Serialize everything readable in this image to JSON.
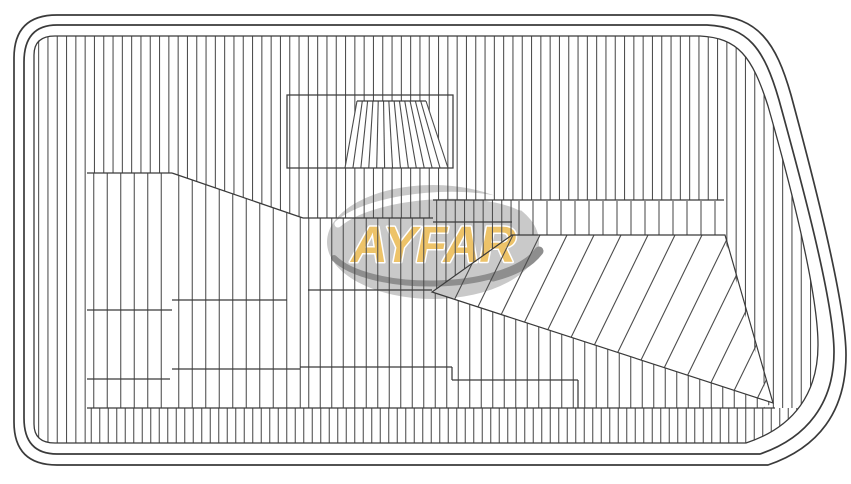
{
  "meta": {
    "title": "AYFAR headlamp lens technical drawing"
  },
  "logo": {
    "text": "AYFAR",
    "text_color": "#EDC369",
    "text_outline": "#FFFFFF",
    "ellipse_color": "#C9C9C9",
    "highlight_color": "#FFFFFF",
    "swoosh_color": "#8E8E8E"
  },
  "drawing": {
    "canvas": {
      "width": 851,
      "height": 484,
      "background": "#FFFFFF"
    },
    "line_color": "#4C4C4C",
    "border_color": "#3A3A3A",
    "borders": {
      "outer": "M 57,15 L 712,15 C 758,17 776,42 791,95 C 808,158 846,300 846,355 C 846,412 818,448 768,465 L 57,465 Q 14,465 14,422 L 14,58 Q 14,15 57,15 Z",
      "inner": "M 57,25 L 707,25 C 748,27 764,48 779,100 C 796,162 834,298 834,352 C 834,403 807,438 760,454 L 57,454 Q 24,454 24,418 L 24,62 Q 24,25 57,25 Z",
      "hatch_boundary": "M 55,36 L 700,36 C 738,38 752,56 768,106 C 788,176 818,290 818,345 C 818,392 795,427 746,443 L 55,443 Q 34,443 34,424 L 34,55 Q 34,36 55,36 Z"
    },
    "regions": [
      {
        "name": "main-field",
        "type": "v",
        "pitch": 9.3,
        "points": [
          [
            34,
            36
          ],
          [
            845,
            36
          ],
          [
            845,
            408
          ],
          [
            763,
            408
          ],
          [
            769,
            403
          ],
          [
            724,
            236
          ],
          [
            724,
            200
          ],
          [
            433,
            200
          ],
          [
            433,
            218
          ],
          [
            303,
            218
          ],
          [
            172,
            173
          ],
          [
            87,
            173
          ],
          [
            87,
            443
          ],
          [
            34,
            443
          ]
        ]
      },
      {
        "name": "sub-top",
        "type": "v",
        "pitch": 9.3,
        "points": [
          [
            433,
            200
          ],
          [
            512,
            200
          ],
          [
            512,
            235
          ],
          [
            432,
            292
          ]
        ]
      },
      {
        "name": "mid-tick-band",
        "type": "v",
        "pitch": 14,
        "points": [
          [
            512,
            201
          ],
          [
            724,
            201
          ],
          [
            724,
            235
          ],
          [
            512,
            235
          ]
        ]
      },
      {
        "name": "mid-left-a",
        "type": "v",
        "pitch": 13.5,
        "points": [
          [
            87,
            173
          ],
          [
            172,
            173
          ],
          [
            172,
            408
          ],
          [
            87,
            408
          ]
        ]
      },
      {
        "name": "mid-left-b",
        "type": "v",
        "pitch": 13.5,
        "points": [
          [
            172,
            173
          ],
          [
            303,
            218
          ],
          [
            303,
            408
          ],
          [
            172,
            408
          ]
        ]
      },
      {
        "name": "mid-low",
        "type": "v",
        "pitch": 11.5,
        "points": [
          [
            303,
            218
          ],
          [
            433,
            218
          ],
          [
            432,
            292
          ],
          [
            773,
            403
          ],
          [
            763,
            408
          ],
          [
            303,
            408
          ]
        ]
      },
      {
        "name": "corner-fan",
        "type": "d",
        "pitch": 27,
        "angle": 64,
        "points": [
          [
            512,
            235
          ],
          [
            725,
            235
          ],
          [
            773,
            403
          ],
          [
            432,
            292
          ]
        ]
      },
      {
        "name": "bottom-band",
        "type": "v",
        "pitch": 8.5,
        "points": [
          [
            87,
            408
          ],
          [
            805,
            408
          ],
          [
            805,
            443
          ],
          [
            87,
            443
          ]
        ]
      }
    ],
    "fan_outline": [
      [
        512,
        235
      ],
      [
        725,
        235
      ],
      [
        773,
        403
      ],
      [
        432,
        292
      ]
    ],
    "boundary_segments": [
      [
        87,
        173,
        172,
        173
      ],
      [
        172,
        173,
        303,
        218
      ],
      [
        303,
        218,
        433,
        218
      ],
      [
        433,
        200,
        724,
        200
      ],
      [
        433,
        222,
        512,
        222
      ],
      [
        308,
        290,
        432,
        290
      ],
      [
        172,
        300,
        287,
        300
      ],
      [
        87,
        310,
        172,
        310
      ],
      [
        300,
        367,
        452,
        367
      ],
      [
        452,
        367,
        452,
        380
      ],
      [
        452,
        380,
        578,
        380
      ],
      [
        578,
        380,
        578,
        408
      ],
      [
        172,
        369,
        300,
        369
      ],
      [
        87,
        379,
        170,
        379
      ],
      [
        87,
        408,
        775,
        408
      ],
      [
        357,
        101,
        426,
        101
      ]
    ],
    "flute": {
      "box": {
        "x": 287,
        "y": 95,
        "w": 166,
        "h": 73
      },
      "trapezoid": {
        "top_y": 101,
        "top_x1": 357,
        "top_x2": 426,
        "bot_y": 168,
        "bot_x1": 345,
        "bot_x2": 448,
        "lines": 14
      }
    },
    "logo_layout": {
      "cx": 433,
      "cy": 242,
      "rx": 106,
      "ry": 57,
      "text_y": 262
    }
  }
}
